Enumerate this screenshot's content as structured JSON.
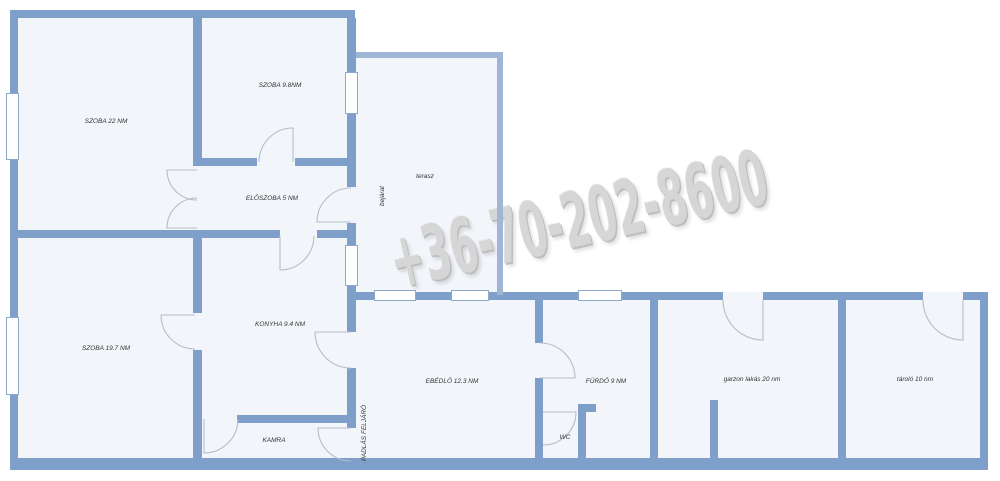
{
  "watermark": {
    "phone": "+36-70-202-8600"
  },
  "colors": {
    "wall": "#7e9fca",
    "wall_light": "#9fb6d6",
    "floor": "#f2f5fa",
    "window_border": "#8fa7c8",
    "door_arc": "#b6bdc9",
    "label": "#333333",
    "watermark": "#d6d6d6",
    "background": "#ffffff"
  },
  "rooms": {
    "szoba22": {
      "label": "SZOBA 22 NM"
    },
    "szoba98": {
      "label": "SZOBA 9.8NM"
    },
    "eloszoba": {
      "label": "ELŐSZOBA 5 NM"
    },
    "terasz": {
      "label": "terasz"
    },
    "bejarat": {
      "label": "bejárat"
    },
    "szoba197": {
      "label": "SZOBA 19.7 NM"
    },
    "konyha": {
      "label": "KONYHA 9.4 NM"
    },
    "kamra": {
      "label": "KAMRA"
    },
    "padlas": {
      "label": "PADLÁS FELJÁRÓ"
    },
    "ebedlo": {
      "label": "EBÉDLŐ 12.3 NM"
    },
    "furdo": {
      "label": "FÜRDŐ 9 NM"
    },
    "wc": {
      "label": "WC"
    },
    "garzon": {
      "label": "garzon lakás 20 nm"
    },
    "tarolo": {
      "label": "tároló 10 nm"
    }
  }
}
